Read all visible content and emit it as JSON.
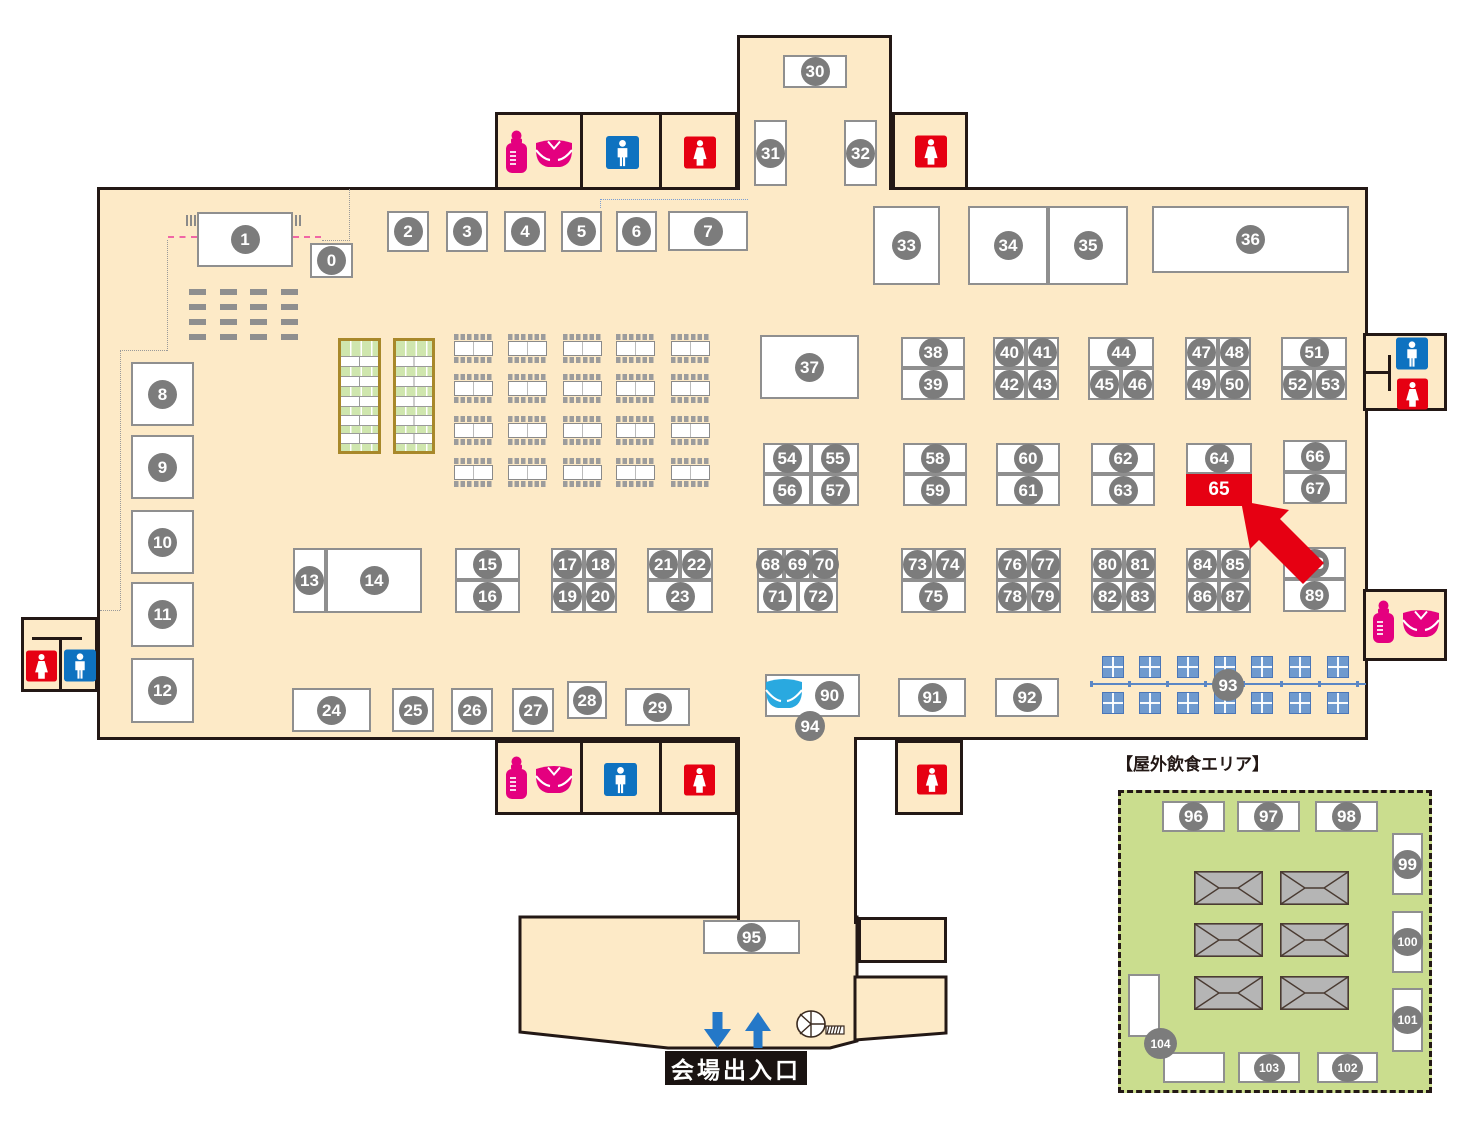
{
  "labels": {
    "outdoor_area": "【屋外飲食エリア】",
    "entrance": "会場出入口"
  },
  "highlighted_booth": "65",
  "colors": {
    "floor": "#fdeac7",
    "wall": "#231815",
    "booth_border": "#8f8f8f",
    "number_circle": "#7c7c7c",
    "highlight_red": "#e60012",
    "baby_pink": "#e4007f",
    "toilet_blue": "#0e72c0",
    "toilet_red": "#e60012",
    "diaper_blue": "#29a9e0",
    "outdoor_green": "#cadd8e",
    "mat_green": "#cfe6ae",
    "table_blue": "#6f9ace",
    "arrow_blue": "#2478c8"
  },
  "booths": [
    {
      "n": "1",
      "x": 197,
      "y": 212,
      "w": 96,
      "h": 55
    },
    {
      "n": "0",
      "x": 310,
      "y": 243,
      "w": 43,
      "h": 35
    },
    {
      "n": "2",
      "x": 387,
      "y": 211,
      "w": 42,
      "h": 41
    },
    {
      "n": "3",
      "x": 446,
      "y": 211,
      "w": 42,
      "h": 41
    },
    {
      "n": "4",
      "x": 504,
      "y": 211,
      "w": 42,
      "h": 41
    },
    {
      "n": "5",
      "x": 561,
      "y": 211,
      "w": 41,
      "h": 41
    },
    {
      "n": "6",
      "x": 616,
      "y": 211,
      "w": 41,
      "h": 41
    },
    {
      "n": "7",
      "x": 668,
      "y": 211,
      "w": 80,
      "h": 40
    },
    {
      "n": "30",
      "x": 783,
      "y": 55,
      "w": 64,
      "h": 33
    },
    {
      "n": "31",
      "x": 754,
      "y": 120,
      "w": 33,
      "h": 66
    },
    {
      "n": "32",
      "x": 844,
      "y": 120,
      "w": 33,
      "h": 66
    },
    {
      "n": "33",
      "x": 873,
      "y": 206,
      "w": 67,
      "h": 79
    },
    {
      "n": "34",
      "x": 968,
      "y": 206,
      "w": 80,
      "h": 79
    },
    {
      "n": "35",
      "x": 1048,
      "y": 206,
      "w": 80,
      "h": 79
    },
    {
      "n": "36",
      "x": 1152,
      "y": 206,
      "w": 197,
      "h": 67
    },
    {
      "n": "8",
      "x": 131,
      "y": 362,
      "w": 63,
      "h": 64
    },
    {
      "n": "9",
      "x": 131,
      "y": 435,
      "w": 63,
      "h": 64
    },
    {
      "n": "10",
      "x": 131,
      "y": 510,
      "w": 63,
      "h": 64
    },
    {
      "n": "11",
      "x": 131,
      "y": 582,
      "w": 63,
      "h": 65
    },
    {
      "n": "12",
      "x": 131,
      "y": 658,
      "w": 63,
      "h": 65
    },
    {
      "n": "37",
      "x": 760,
      "y": 335,
      "w": 99,
      "h": 64
    },
    {
      "n": "38",
      "x": 901,
      "y": 337,
      "w": 64,
      "h": 31
    },
    {
      "n": "39",
      "x": 901,
      "y": 368,
      "w": 64,
      "h": 32
    },
    {
      "n": "40",
      "x": 993,
      "y": 337,
      "w": 33,
      "h": 31
    },
    {
      "n": "41",
      "x": 1026,
      "y": 337,
      "w": 33,
      "h": 31
    },
    {
      "n": "42",
      "x": 993,
      "y": 368,
      "w": 33,
      "h": 32
    },
    {
      "n": "43",
      "x": 1026,
      "y": 368,
      "w": 33,
      "h": 32
    },
    {
      "n": "44",
      "x": 1088,
      "y": 337,
      "w": 66,
      "h": 31
    },
    {
      "n": "45",
      "x": 1088,
      "y": 368,
      "w": 33,
      "h": 32
    },
    {
      "n": "46",
      "x": 1121,
      "y": 368,
      "w": 33,
      "h": 32
    },
    {
      "n": "47",
      "x": 1185,
      "y": 337,
      "w": 33,
      "h": 31
    },
    {
      "n": "48",
      "x": 1218,
      "y": 337,
      "w": 33,
      "h": 31
    },
    {
      "n": "49",
      "x": 1185,
      "y": 368,
      "w": 33,
      "h": 32
    },
    {
      "n": "50",
      "x": 1218,
      "y": 368,
      "w": 33,
      "h": 32
    },
    {
      "n": "51",
      "x": 1281,
      "y": 337,
      "w": 66,
      "h": 31
    },
    {
      "n": "52",
      "x": 1281,
      "y": 368,
      "w": 33,
      "h": 32
    },
    {
      "n": "53",
      "x": 1314,
      "y": 368,
      "w": 33,
      "h": 32
    },
    {
      "n": "54",
      "x": 763,
      "y": 443,
      "w": 48,
      "h": 31
    },
    {
      "n": "55",
      "x": 811,
      "y": 443,
      "w": 48,
      "h": 31
    },
    {
      "n": "56",
      "x": 763,
      "y": 474,
      "w": 48,
      "h": 32
    },
    {
      "n": "57",
      "x": 811,
      "y": 474,
      "w": 48,
      "h": 32
    },
    {
      "n": "58",
      "x": 903,
      "y": 443,
      "w": 64,
      "h": 31
    },
    {
      "n": "59",
      "x": 903,
      "y": 474,
      "w": 64,
      "h": 32
    },
    {
      "n": "60",
      "x": 996,
      "y": 443,
      "w": 64,
      "h": 31
    },
    {
      "n": "61",
      "x": 996,
      "y": 474,
      "w": 64,
      "h": 32
    },
    {
      "n": "62",
      "x": 1091,
      "y": 443,
      "w": 64,
      "h": 31
    },
    {
      "n": "63",
      "x": 1091,
      "y": 474,
      "w": 64,
      "h": 32
    },
    {
      "n": "64",
      "x": 1186,
      "y": 443,
      "w": 66,
      "h": 31
    },
    {
      "n": "65",
      "x": 1186,
      "y": 474,
      "w": 66,
      "h": 32,
      "red": 1
    },
    {
      "n": "66",
      "x": 1283,
      "y": 440,
      "w": 64,
      "h": 32
    },
    {
      "n": "67",
      "x": 1283,
      "y": 472,
      "w": 64,
      "h": 32
    },
    {
      "n": "13",
      "x": 293,
      "y": 548,
      "w": 33,
      "h": 65
    },
    {
      "n": "14",
      "x": 326,
      "y": 548,
      "w": 96,
      "h": 65
    },
    {
      "n": "15",
      "x": 455,
      "y": 548,
      "w": 65,
      "h": 32
    },
    {
      "n": "16",
      "x": 455,
      "y": 580,
      "w": 65,
      "h": 33
    },
    {
      "n": "17",
      "x": 551,
      "y": 548,
      "w": 33,
      "h": 32
    },
    {
      "n": "18",
      "x": 584,
      "y": 548,
      "w": 33,
      "h": 32
    },
    {
      "n": "19",
      "x": 551,
      "y": 580,
      "w": 33,
      "h": 33
    },
    {
      "n": "20",
      "x": 584,
      "y": 580,
      "w": 33,
      "h": 33
    },
    {
      "n": "21",
      "x": 647,
      "y": 548,
      "w": 33,
      "h": 32
    },
    {
      "n": "22",
      "x": 680,
      "y": 548,
      "w": 33,
      "h": 32
    },
    {
      "n": "23",
      "x": 647,
      "y": 580,
      "w": 66,
      "h": 33
    },
    {
      "n": "68",
      "x": 757,
      "y": 548,
      "w": 27,
      "h": 32
    },
    {
      "n": "69",
      "x": 784,
      "y": 548,
      "w": 27,
      "h": 32
    },
    {
      "n": "70",
      "x": 811,
      "y": 548,
      "w": 27,
      "h": 32
    },
    {
      "n": "71",
      "x": 757,
      "y": 580,
      "w": 41,
      "h": 33
    },
    {
      "n": "72",
      "x": 798,
      "y": 580,
      "w": 40,
      "h": 33
    },
    {
      "n": "73",
      "x": 901,
      "y": 548,
      "w": 33,
      "h": 32
    },
    {
      "n": "74",
      "x": 934,
      "y": 548,
      "w": 32,
      "h": 32
    },
    {
      "n": "75",
      "x": 901,
      "y": 580,
      "w": 65,
      "h": 33
    },
    {
      "n": "76",
      "x": 996,
      "y": 548,
      "w": 33,
      "h": 32
    },
    {
      "n": "77",
      "x": 1029,
      "y": 548,
      "w": 32,
      "h": 32
    },
    {
      "n": "78",
      "x": 996,
      "y": 580,
      "w": 33,
      "h": 33
    },
    {
      "n": "79",
      "x": 1029,
      "y": 580,
      "w": 32,
      "h": 33
    },
    {
      "n": "80",
      "x": 1091,
      "y": 548,
      "w": 33,
      "h": 32
    },
    {
      "n": "81",
      "x": 1124,
      "y": 548,
      "w": 32,
      "h": 32
    },
    {
      "n": "82",
      "x": 1091,
      "y": 580,
      "w": 33,
      "h": 33
    },
    {
      "n": "83",
      "x": 1124,
      "y": 580,
      "w": 32,
      "h": 33
    },
    {
      "n": "84",
      "x": 1186,
      "y": 548,
      "w": 33,
      "h": 32
    },
    {
      "n": "85",
      "x": 1219,
      "y": 548,
      "w": 32,
      "h": 32
    },
    {
      "n": "86",
      "x": 1186,
      "y": 580,
      "w": 33,
      "h": 33
    },
    {
      "n": "87",
      "x": 1219,
      "y": 580,
      "w": 32,
      "h": 33
    },
    {
      "n": "88",
      "x": 1283,
      "y": 547,
      "w": 63,
      "h": 32
    },
    {
      "n": "89",
      "x": 1283,
      "y": 579,
      "w": 63,
      "h": 33
    },
    {
      "n": "24",
      "x": 292,
      "y": 688,
      "w": 79,
      "h": 44
    },
    {
      "n": "25",
      "x": 392,
      "y": 688,
      "w": 42,
      "h": 44
    },
    {
      "n": "26",
      "x": 451,
      "y": 688,
      "w": 42,
      "h": 44
    },
    {
      "n": "27",
      "x": 512,
      "y": 688,
      "w": 42,
      "h": 44
    },
    {
      "n": "28",
      "x": 567,
      "y": 681,
      "w": 40,
      "h": 38
    },
    {
      "n": "29",
      "x": 625,
      "y": 688,
      "w": 65,
      "h": 38
    },
    {
      "n": "90",
      "x": 765,
      "y": 674,
      "w": 95,
      "h": 43,
      "cx": 0.68
    },
    {
      "n": "91",
      "x": 898,
      "y": 678,
      "w": 68,
      "h": 39
    },
    {
      "n": "92",
      "x": 995,
      "y": 678,
      "w": 64,
      "h": 39
    },
    {
      "n": "93",
      "circle": 1,
      "x": 1212,
      "y": 669,
      "w": 32,
      "h": 32
    },
    {
      "n": "94",
      "circle": 1,
      "x": 795,
      "y": 711,
      "w": 30,
      "h": 30
    },
    {
      "n": "95",
      "x": 703,
      "y": 920,
      "w": 97,
      "h": 34
    },
    {
      "n": "96",
      "x": 1162,
      "y": 801,
      "w": 63,
      "h": 31
    },
    {
      "n": "97",
      "x": 1237,
      "y": 801,
      "w": 63,
      "h": 31
    },
    {
      "n": "98",
      "x": 1315,
      "y": 801,
      "w": 63,
      "h": 31
    },
    {
      "n": "99",
      "x": 1392,
      "y": 833,
      "w": 31,
      "h": 62
    },
    {
      "n": "100",
      "x": 1392,
      "y": 911,
      "w": 31,
      "h": 62
    },
    {
      "n": "101",
      "x": 1392,
      "y": 988,
      "w": 31,
      "h": 64
    },
    {
      "n": "102",
      "x": 1317,
      "y": 1052,
      "w": 61,
      "h": 31
    },
    {
      "n": "103",
      "x": 1238,
      "y": 1052,
      "w": 62,
      "h": 31
    },
    {
      "n": "",
      "x": 1128,
      "y": 974,
      "w": 32,
      "h": 63
    },
    {
      "n": "",
      "x": 1163,
      "y": 1052,
      "w": 62,
      "h": 31
    },
    {
      "n": "104",
      "circle": 1,
      "x": 1144,
      "y": 1028,
      "w": 33,
      "h": 31
    }
  ],
  "facilities": [
    {
      "type": "baby-care",
      "x": 503,
      "y": 130,
      "w": 72,
      "h": 44
    },
    {
      "type": "toilet-male",
      "x": 606,
      "y": 136,
      "w": 33,
      "h": 33
    },
    {
      "type": "toilet-female",
      "x": 684,
      "y": 136,
      "w": 32,
      "h": 33
    },
    {
      "type": "toilet-female",
      "x": 915,
      "y": 135,
      "w": 32,
      "h": 33
    },
    {
      "type": "toilet-male",
      "x": 1396,
      "y": 337,
      "w": 32,
      "h": 33
    },
    {
      "type": "toilet-female",
      "x": 1397,
      "y": 378,
      "w": 31,
      "h": 32
    },
    {
      "type": "toilet-female",
      "x": 26,
      "y": 650,
      "w": 31,
      "h": 32
    },
    {
      "type": "toilet-male",
      "x": 64,
      "y": 649,
      "w": 32,
      "h": 33
    },
    {
      "type": "baby-care",
      "x": 1370,
      "y": 600,
      "w": 72,
      "h": 44
    },
    {
      "type": "baby-care",
      "x": 503,
      "y": 756,
      "w": 72,
      "h": 44
    },
    {
      "type": "toilet-male",
      "x": 604,
      "y": 763,
      "w": 33,
      "h": 33
    },
    {
      "type": "toilet-female",
      "x": 684,
      "y": 764,
      "w": 31,
      "h": 32
    },
    {
      "type": "toilet-female",
      "x": 917,
      "y": 764,
      "w": 30,
      "h": 31
    },
    {
      "type": "diaper",
      "x": 763,
      "y": 674,
      "w": 42,
      "h": 41
    },
    {
      "type": "stairs",
      "x": 788,
      "y": 1005,
      "w": 62,
      "h": 40
    },
    {
      "type": "arrow-down",
      "x": 704,
      "y": 1012,
      "w": 27,
      "h": 36
    },
    {
      "type": "arrow-up",
      "x": 745,
      "y": 1012,
      "w": 26,
      "h": 36
    },
    {
      "type": "highlight-arrow",
      "x": 1241,
      "y": 501,
      "w": 100,
      "h": 100
    }
  ]
}
